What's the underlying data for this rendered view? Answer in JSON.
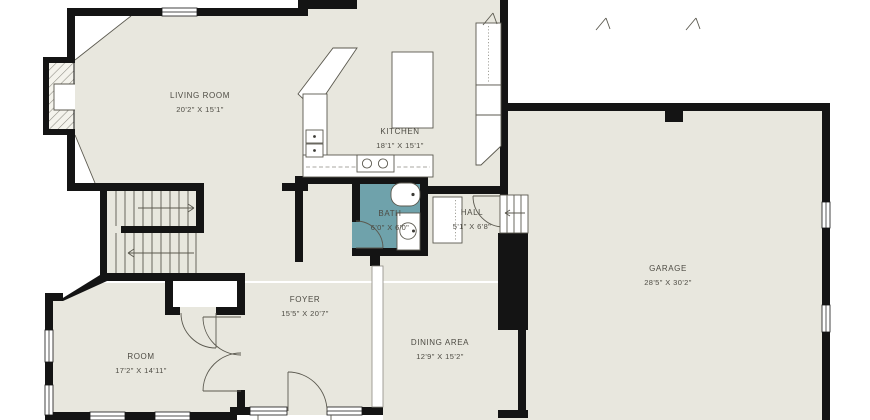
{
  "plan": {
    "type": "floor-plan",
    "colors": {
      "floor": "#e8e7de",
      "wall": "#141414",
      "bath": "#6fa2ab",
      "text": "#4d4b43",
      "line": "#5b594f"
    },
    "rooms": [
      {
        "name": "LIVING ROOM",
        "dims": "20'2\" X 15'1\""
      },
      {
        "name": "KITCHEN",
        "dims": "18'1\" X 15'1\""
      },
      {
        "name": "BATH",
        "dims": "6'0\" X 6'0\""
      },
      {
        "name": "HALL",
        "dims": "5'1\" X 6'8\""
      },
      {
        "name": "GARAGE",
        "dims": "28'5\" X 30'2\""
      },
      {
        "name": "FOYER",
        "dims": "15'5\" X 20'7\""
      },
      {
        "name": "ROOM",
        "dims": "17'2\" X 14'11\""
      },
      {
        "name": "DINING AREA",
        "dims": "12'9\" X 15'2\""
      }
    ]
  }
}
